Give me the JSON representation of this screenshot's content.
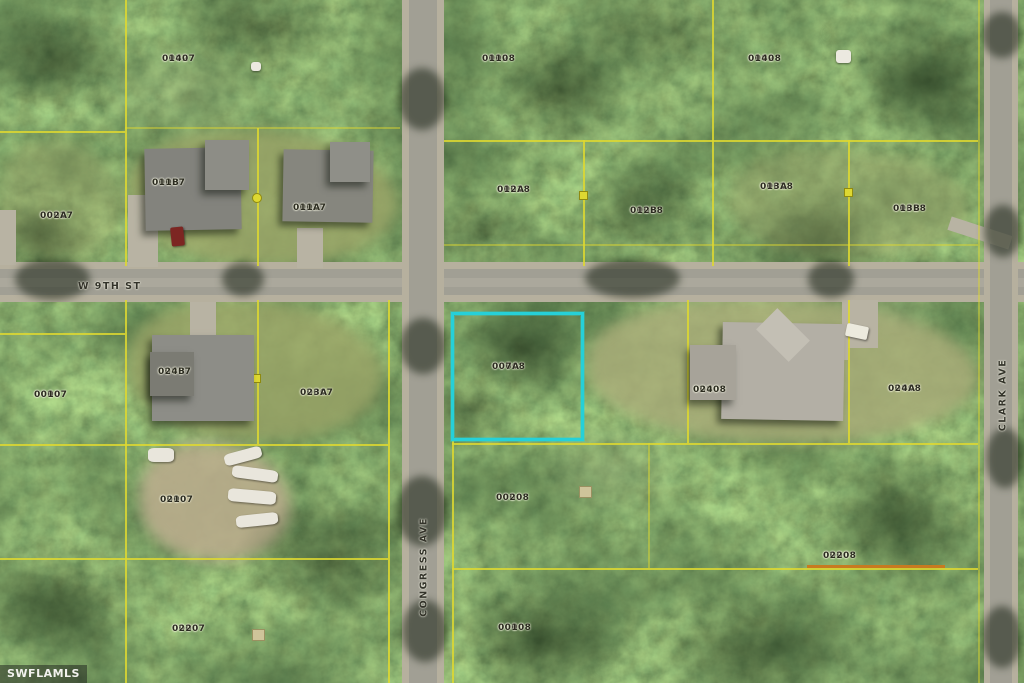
{
  "watermark": "SWFLAMLS",
  "streets": {
    "w9th": "W 9TH ST",
    "congress": "CONGRESS AVE",
    "clark": "CLARK AVE"
  },
  "highlight": {
    "parcel_id": "00008 007A",
    "color": "#26d0d8"
  },
  "colors": {
    "parcel_line": "#ded832",
    "accent_boundary": "#c87a20",
    "highlight": "#26d0d8"
  },
  "parcels": [
    {
      "line1": "00027",
      "line2": "0140"
    },
    {
      "line1": "00028",
      "line2": "0110"
    },
    {
      "line1": "00028",
      "line2": "0140"
    },
    {
      "line1": "00027",
      "line2": "011B"
    },
    {
      "line1": "00027",
      "line2": "011A"
    },
    {
      "line1": "00028",
      "line2": "012A"
    },
    {
      "line1": "00028",
      "line2": "012B"
    },
    {
      "line1": "00028",
      "line2": "013A"
    },
    {
      "line1": "00028",
      "line2": "013B"
    },
    {
      "line1": "00027",
      "line2": "002A"
    },
    {
      "line1": "00007",
      "line2": "0010"
    },
    {
      "line1": "00007",
      "line2": "024B"
    },
    {
      "line1": "00007",
      "line2": "023A"
    },
    {
      "line1": "00008",
      "line2": "007A"
    },
    {
      "line1": "00008",
      "line2": "0240"
    },
    {
      "line1": "00008",
      "line2": "024A"
    },
    {
      "line1": "00007",
      "line2": "0210"
    },
    {
      "line1": "00008",
      "line2": "0020"
    },
    {
      "line1": "00007",
      "line2": "0220"
    },
    {
      "line1": "00008",
      "line2": "0010"
    },
    {
      "line1": "00008",
      "line2": "0220"
    }
  ]
}
